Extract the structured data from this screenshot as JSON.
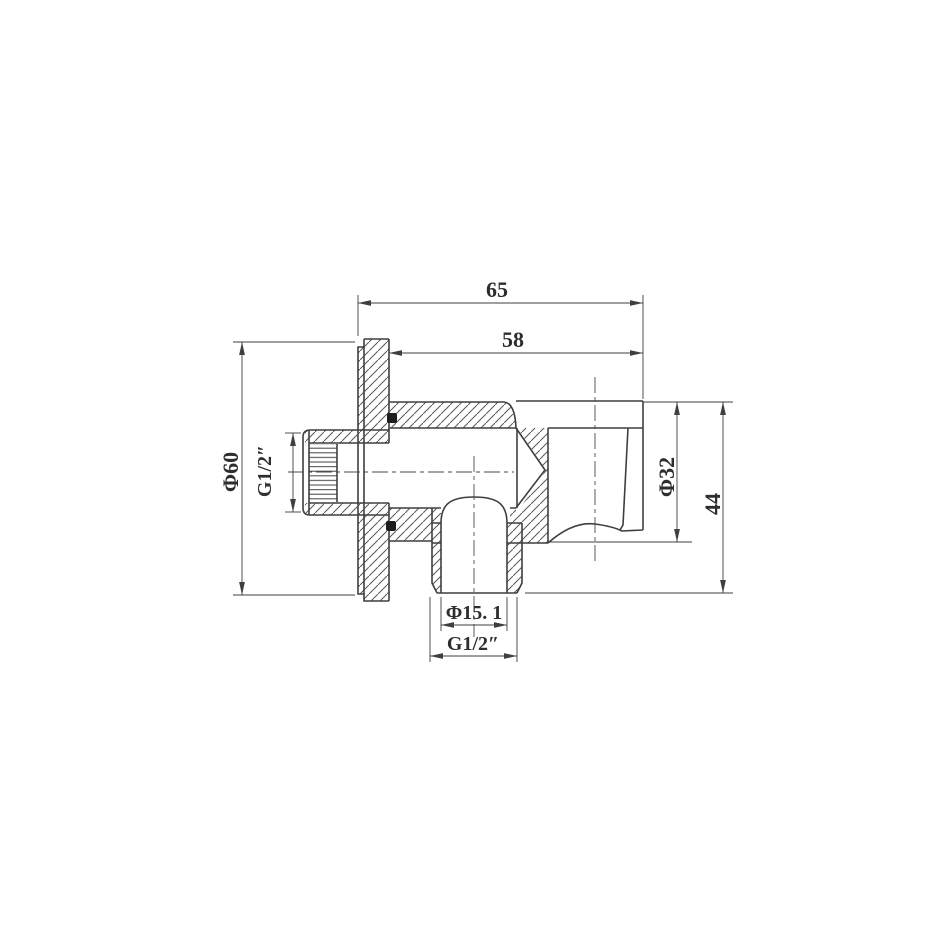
{
  "drawing": {
    "title": "Shower holder wall outlet elbow – cross-section drawing",
    "dimensions": {
      "overall_depth": "65",
      "body_depth": "58",
      "flange_diameter": "Φ60",
      "inlet_thread": "G1/2″",
      "holder_diameter": "Φ32",
      "holder_height": "44",
      "outlet_bore_diameter": "Φ15. 1",
      "outlet_thread": "G1/2″"
    },
    "style": {
      "object_line_color": "#3f3f3f",
      "thin_line_color": "#555555",
      "text_color": "#2e2e2e",
      "background": "#ffffff"
    }
  }
}
